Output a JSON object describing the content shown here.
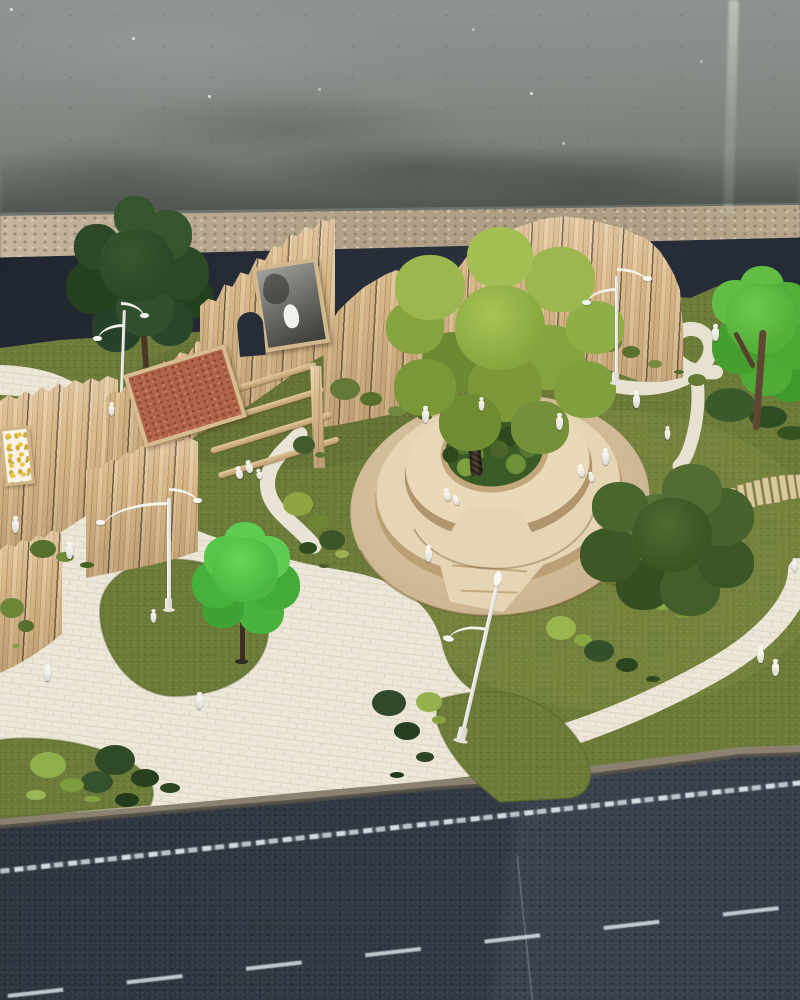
{
  "scene": {
    "description": "Photograph of a physical architectural scale model of a landscaped public park, built on a board placed on a dark chalk-marked work table in front of a weathered concrete wall. The model features tall vertical balsa-wood slat fences with three mounted panels (a cork board, a black-and-white photo with a white cat, and a yellow botanical print), a central circular tiered wooden planter-bench surrounding a large moss-green tree, winding cream brick-textured footpaths over artificial turf, a wooden-slat crosswalk, four white curved street lamps (one leaning), model trees and moss shrubs, and about two dozen tiny white human figures.",
    "environment": {
      "wall": "weathered grey concrete with stains and a pale vertical drip streak",
      "floor_strip": "blurred beige terrazzo floor between wall and table",
      "backdrop": "dark navy board behind the model",
      "table": "dark charcoal sandpaper sheets with dashed white chalk lines and a sheet seam"
    }
  },
  "model": {
    "fence_sections": 6,
    "framed_panels": [
      "cork board panel",
      "black-and-white cat photo panel",
      "yellow botanical print panel"
    ],
    "gate": "open section with four horizontal rails and an arched cut-out",
    "central_feature": "circular two-tier wooden planter bench with inner moss bed and large tree",
    "trees": 5,
    "lamp_posts": 4,
    "leaning_lamp_posts": 1,
    "figures": 24,
    "crosswalk_slats": 10,
    "moss_clusters": 12
  },
  "palette": {
    "concrete_wall": "#848883",
    "terrazzo_floor": "#b3a48b",
    "backdrop_navy": "#272d37",
    "turf_green": "#6d7b3a",
    "path_cream": "#ece7d9",
    "balsa_wood": "#d6b78a",
    "cork_red": "#b0624a",
    "planter_wood": "#e6d5b4",
    "foliage_dark": "#2c4829",
    "foliage_moss": "#92ad47",
    "foliage_bright": "#55c04a",
    "foliage_olive": "#4a662f",
    "lamp_white": "#f4f3ee",
    "table_charcoal": "#323a44",
    "chalk_white": "#ecf2f6"
  }
}
